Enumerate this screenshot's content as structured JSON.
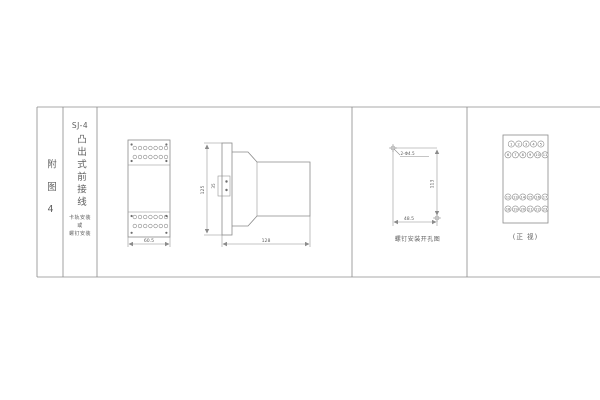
{
  "colors": {
    "line": "#8b8b8b",
    "text": "#5f5f5f",
    "background": "#ffffff"
  },
  "index_column": {
    "label": "附图4"
  },
  "title_column": {
    "model": "SJ-4",
    "type_text": "凸出式前接线",
    "mounting_lines": [
      "卡轨安装",
      "或",
      "螺钉安装"
    ]
  },
  "front_dim_view": {
    "width_dim": "60.5"
  },
  "side_view": {
    "height_dim": "125",
    "clip_dim": "35",
    "depth_dim": "128"
  },
  "drill_view": {
    "holes_label": "2-Φ4.5",
    "height_dim": "113",
    "width_dim": "48.5",
    "caption": "螺钉安装开孔图"
  },
  "front_view": {
    "caption": "(正 视)",
    "terminals": {
      "top_row1": [
        "1",
        "2",
        "3",
        "4",
        "5"
      ],
      "top_row2": [
        "6",
        "7",
        "8",
        "9",
        "10",
        "11"
      ],
      "bottom_row1": [
        "12",
        "13",
        "14",
        "15",
        "16",
        "17"
      ],
      "bottom_row2": [
        "18",
        "19",
        "20",
        "21",
        "22",
        "23"
      ]
    }
  }
}
